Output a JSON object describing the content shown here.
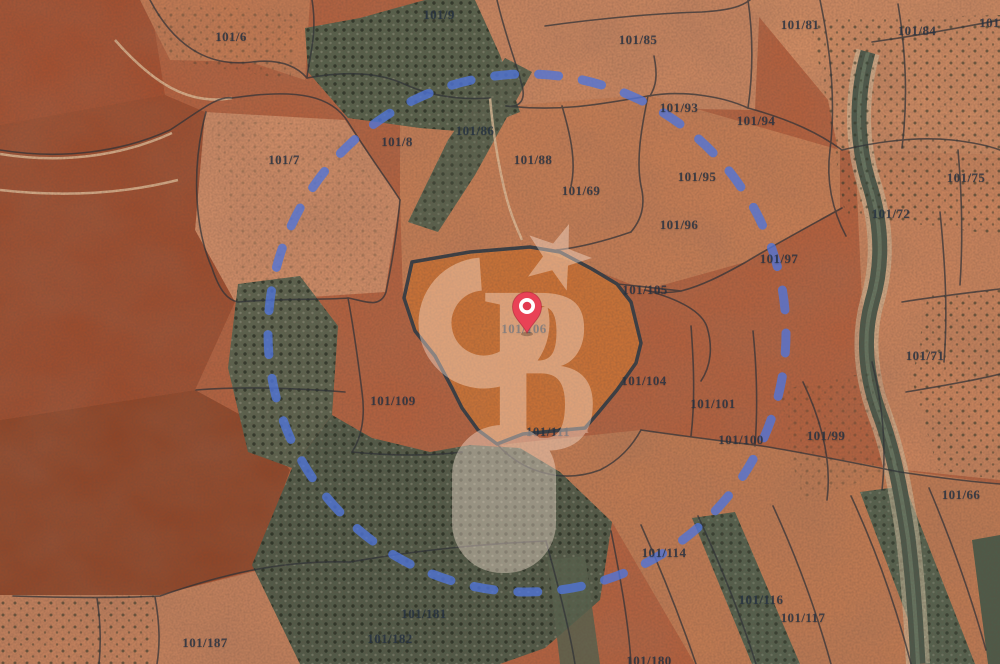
{
  "map": {
    "kind": "satellite-cadastral-map",
    "watermark": {
      "monogram": "CB",
      "letter_b": "B",
      "service_mark": "SM"
    },
    "marker": {
      "parcel": "101/106"
    },
    "highlight": {
      "parcel": "101/106"
    },
    "colors": {
      "circle_blue": "#4f74da",
      "pin_red": "#e94256",
      "pin_dot": "#e23a50",
      "highlight_orange": "#d87e30",
      "watermark_tint": "#ffe9da"
    },
    "parcel_labels": [
      {
        "label": "101/6",
        "x": 231,
        "y": 37
      },
      {
        "label": "101/9",
        "x": 439,
        "y": 15
      },
      {
        "label": "101/85",
        "x": 638,
        "y": 40
      },
      {
        "label": "101/81",
        "x": 800,
        "y": 25
      },
      {
        "label": "101/84",
        "x": 917,
        "y": 31
      },
      {
        "label": "101/8",
        "x": 995,
        "y": 23
      },
      {
        "label": "101/7",
        "x": 284,
        "y": 160
      },
      {
        "label": "101/8",
        "x": 397,
        "y": 142
      },
      {
        "label": "101/86",
        "x": 475,
        "y": 131
      },
      {
        "label": "101/88",
        "x": 533,
        "y": 160
      },
      {
        "label": "101/69",
        "x": 581,
        "y": 191
      },
      {
        "label": "101/93",
        "x": 679,
        "y": 108
      },
      {
        "label": "101/94",
        "x": 756,
        "y": 121
      },
      {
        "label": "101/95",
        "x": 697,
        "y": 177
      },
      {
        "label": "101/96",
        "x": 679,
        "y": 225
      },
      {
        "label": "101/97",
        "x": 779,
        "y": 259
      },
      {
        "label": "101/72",
        "x": 891,
        "y": 214
      },
      {
        "label": "101/75",
        "x": 966,
        "y": 178
      },
      {
        "label": "101/105",
        "x": 645,
        "y": 290
      },
      {
        "label": "101/106",
        "x": 524,
        "y": 329
      },
      {
        "label": "101/71",
        "x": 925,
        "y": 356
      },
      {
        "label": "101/104",
        "x": 644,
        "y": 381
      },
      {
        "label": "101/109",
        "x": 393,
        "y": 401
      },
      {
        "label": "101/111",
        "x": 548,
        "y": 432
      },
      {
        "label": "101/101",
        "x": 713,
        "y": 404
      },
      {
        "label": "101/100",
        "x": 741,
        "y": 440
      },
      {
        "label": "101/99",
        "x": 826,
        "y": 436
      },
      {
        "label": "101/66",
        "x": 961,
        "y": 495
      },
      {
        "label": "101/114",
        "x": 664,
        "y": 553
      },
      {
        "label": "101/116",
        "x": 761,
        "y": 600
      },
      {
        "label": "101/117",
        "x": 803,
        "y": 618
      },
      {
        "label": "101/181",
        "x": 424,
        "y": 614
      },
      {
        "label": "101/182",
        "x": 390,
        "y": 639
      },
      {
        "label": "101/187",
        "x": 205,
        "y": 643
      },
      {
        "label": "101/180",
        "x": 649,
        "y": 661
      }
    ]
  }
}
